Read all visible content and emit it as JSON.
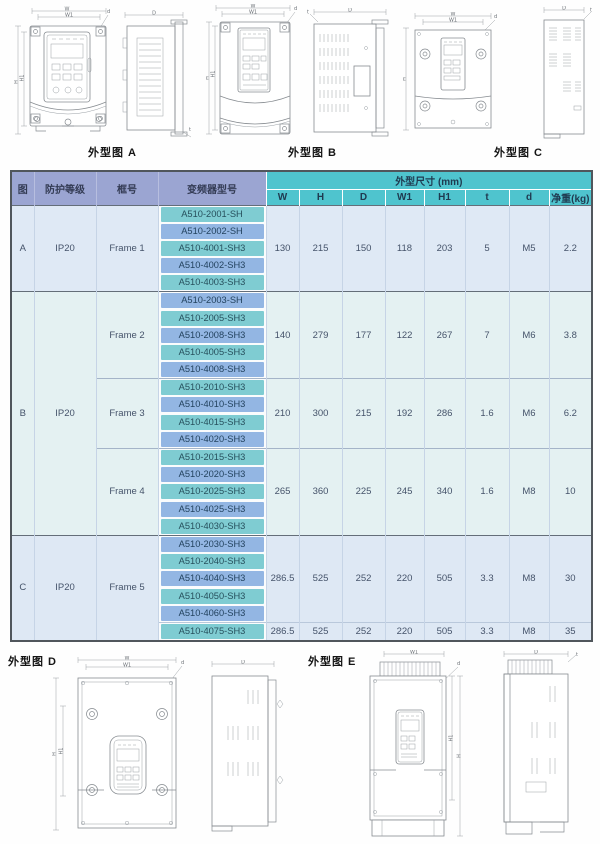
{
  "figures": {
    "a": "外型图 A",
    "b": "外型图 B",
    "c": "外型图 C",
    "d": "外型图 D",
    "e": "外型图 E"
  },
  "dims": {
    "w": "W",
    "w1": "W1",
    "h": "H",
    "h1": "H1",
    "depth": "D",
    "hole": "d",
    "t": "t"
  },
  "colors": {
    "header_left_bg": "#9ba5d2",
    "header_dims_bg": "#4fc4ce",
    "model_teal": "#7fccd2",
    "model_blue": "#93b6e3",
    "group_a_bg": "#dfe9f5",
    "group_b_bg": "#e4f1f2",
    "group_c_bg": "#dee8f4",
    "border_dark": "#50565c"
  },
  "table": {
    "header": {
      "fig": "图",
      "protection": "防护等级",
      "frame": "框号",
      "model": "变频器型号",
      "dims_group": "外型尺寸 (mm)",
      "dim_cols": [
        "W",
        "H",
        "D",
        "W1",
        "H1",
        "t",
        "d",
        "净重(kg)"
      ]
    },
    "groups": [
      {
        "fig": "A",
        "protection": "IP20",
        "frames": [
          {
            "name": "Frame 1",
            "blocks": [
              {
                "models": [
                  "A510-2001-SH",
                  "A510-2002-SH",
                  "A510-4001-SH3",
                  "A510-4002-SH3",
                  "A510-4003-SH3"
                ],
                "dims": [
                  "130",
                  "215",
                  "150",
                  "118",
                  "203",
                  "5",
                  "M5",
                  "2.2"
                ]
              }
            ]
          }
        ]
      },
      {
        "fig": "B",
        "protection": "IP20",
        "frames": [
          {
            "name": "Frame 2",
            "blocks": [
              {
                "models": [
                  "A510-2003-SH",
                  "A510-2005-SH3",
                  "A510-2008-SH3",
                  "A510-4005-SH3",
                  "A510-4008-SH3"
                ],
                "dims": [
                  "140",
                  "279",
                  "177",
                  "122",
                  "267",
                  "7",
                  "M6",
                  "3.8"
                ]
              }
            ]
          },
          {
            "name": "Frame 3",
            "blocks": [
              {
                "models": [
                  "A510-2010-SH3",
                  "A510-4010-SH3",
                  "A510-4015-SH3",
                  "A510-4020-SH3"
                ],
                "dims": [
                  "210",
                  "300",
                  "215",
                  "192",
                  "286",
                  "1.6",
                  "M6",
                  "6.2"
                ]
              }
            ]
          },
          {
            "name": "Frame 4",
            "blocks": [
              {
                "models": [
                  "A510-2015-SH3",
                  "A510-2020-SH3",
                  "A510-2025-SH3",
                  "A510-4025-SH3",
                  "A510-4030-SH3"
                ],
                "dims": [
                  "265",
                  "360",
                  "225",
                  "245",
                  "340",
                  "1.6",
                  "M8",
                  "10"
                ]
              }
            ]
          }
        ]
      },
      {
        "fig": "C",
        "protection": "IP20",
        "frames": [
          {
            "name": "Frame 5",
            "blocks": [
              {
                "models": [
                  "A510-2030-SH3",
                  "A510-2040-SH3",
                  "A510-4040-SH3",
                  "A510-4050-SH3",
                  "A510-4060-SH3"
                ],
                "dims": [
                  "286.5",
                  "525",
                  "252",
                  "220",
                  "505",
                  "3.3",
                  "M8",
                  "30"
                ]
              },
              {
                "models": [
                  "A510-4075-SH3"
                ],
                "dims": [
                  "286.5",
                  "525",
                  "252",
                  "220",
                  "505",
                  "3.3",
                  "M8",
                  "35"
                ]
              }
            ]
          }
        ]
      }
    ]
  }
}
